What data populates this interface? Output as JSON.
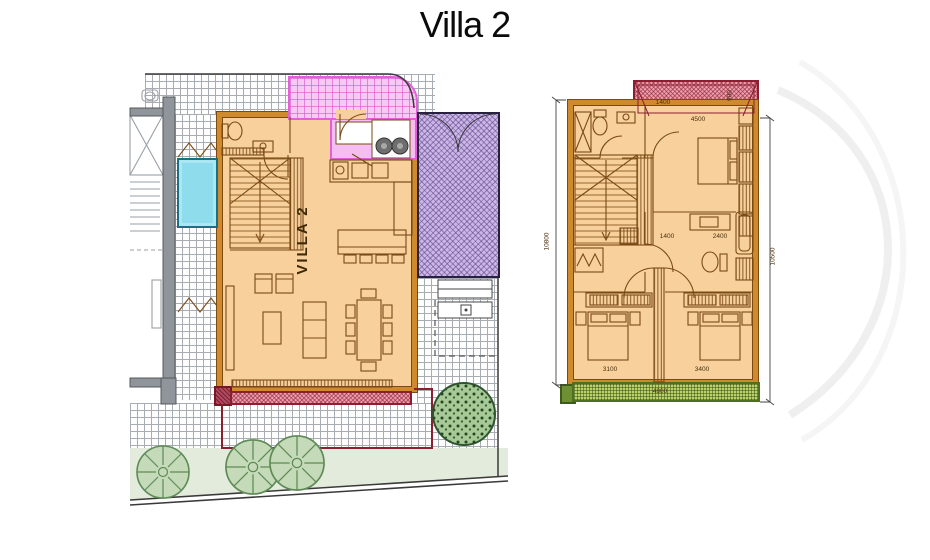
{
  "title": "Villa 2",
  "ground_floor": {
    "unit_label": "VILLA 2"
  },
  "first_floor": {
    "dims": {
      "height_left": "10800",
      "height_right": "10500",
      "terrace_width": "4800",
      "bedroom_top_width": "4500",
      "hall_width": "1400",
      "bath_width": "2400",
      "bedroom_left_width": "3100",
      "bedroom_right_width": "3400",
      "balcony_width": "1400",
      "balcony_depth": "900"
    }
  },
  "colors": {
    "floor_sand": "#f7d09c",
    "wall_orange": "#cf8a2e",
    "pool_cyan": "#8edcec",
    "garage_purple": "#cbb6e6",
    "kitchen_pink": "#f6bdf2",
    "balcony_red": "#ec9fb0",
    "balcony_green": "#bdd06c",
    "lawn_green": "#e3ecdc"
  }
}
